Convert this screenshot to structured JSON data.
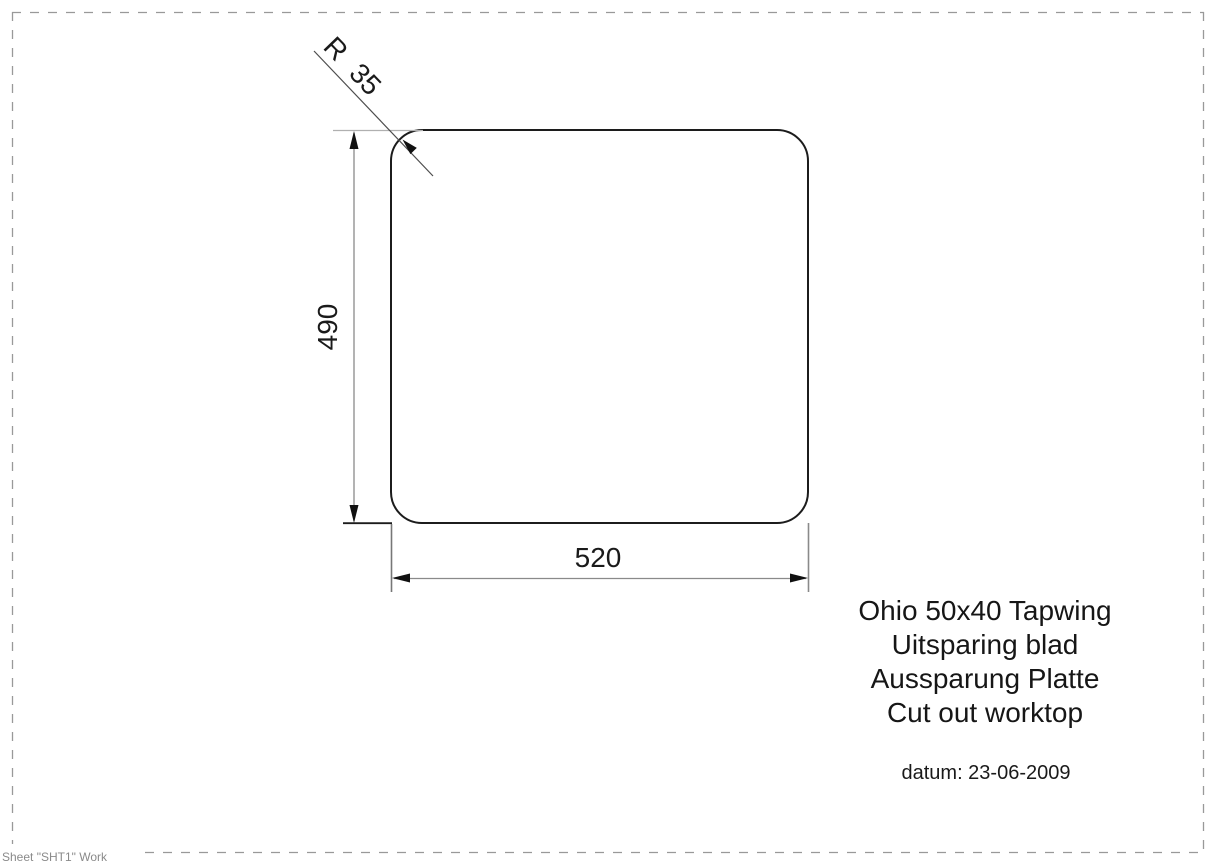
{
  "sheet": {
    "label": "Sheet \"SHT1\" Work"
  },
  "drawing": {
    "dimensions": {
      "height_label": "490",
      "width_label": "520",
      "radius_label": "R 35"
    },
    "title_block": {
      "lines": [
        "Ohio 50x40 Tapwing",
        "Uitsparing blad",
        "Aussparung Platte",
        "Cut out worktop"
      ]
    },
    "date_label": "datum: 23-06-2009",
    "colors": {
      "outline": "#1c1c1c",
      "dimension_line": "#8a8a8a",
      "extension_line": "#b0b0b0",
      "leader_line": "#4d4d4d",
      "arrow": "#111111",
      "page_border": "#999999",
      "sheet_text": "#8a8a8a",
      "background": "#ffffff"
    }
  }
}
